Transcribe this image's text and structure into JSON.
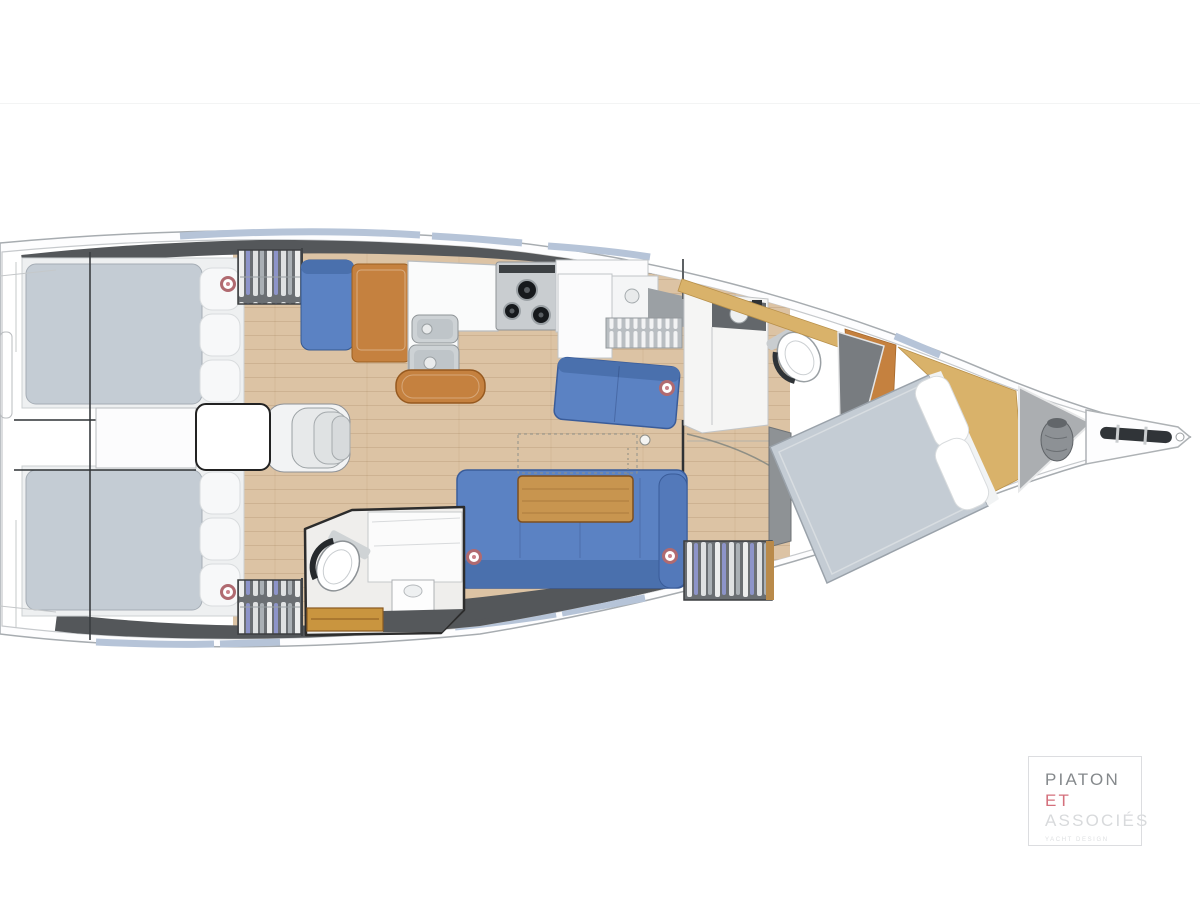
{
  "page": {
    "background": "#ffffff",
    "divider_color": "#f3f4f4"
  },
  "logo": {
    "line1": "PIATON",
    "line2": "ET",
    "line3": "ASSOCIÉS",
    "tagline": "YACHT DESIGN"
  },
  "palette": {
    "hull_outline": "#a7acb0",
    "hull_inner": "#c6c9cc",
    "cabin_band": "#54575a",
    "window_blue": "#b6c4d8",
    "floor_wood": "#dcc3a4",
    "furniture_wood": "#c5813f",
    "table_wood": "#c8954f",
    "shelf_gold": "#d9b26a",
    "upholstery_blue": "#5b82c3",
    "upholstery_dark": "#4a70ad",
    "mattress_gray": "#c4ccd4",
    "locker_gray": "#6b6f73",
    "anchor_locker_gray": "#abaeb1",
    "porthole_red": "#b06a70",
    "stainless": "#c9cdd0",
    "logo_text": "#85898c",
    "logo_accent": "#d4707c",
    "logo_muted": "#d8dadc",
    "logo_tagline": "#dddfe1",
    "logo_border": "#dcdde0"
  }
}
